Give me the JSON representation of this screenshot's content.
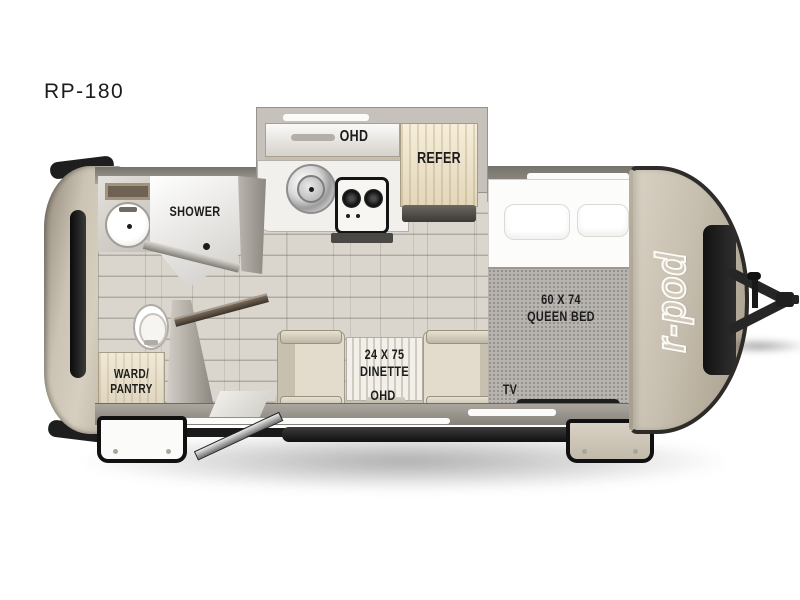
{
  "model_label": "RP-180",
  "brand_logo": "r-pod",
  "rooms": {
    "shower_label": "SHOWER",
    "kitchen_ohd_label": "OHD",
    "refer_label": "REFER",
    "queen_bed_label": "60 X 74\nQUEEN BED",
    "tv_label": "TV",
    "dinette_label": "24 X 75\nDINETTE",
    "dinette_ohd_label": "OHD",
    "ward_pantry_label": "WARD/\nPANTRY"
  },
  "colors": {
    "body_cap_beige": "#c6beae",
    "wall_gray": "#8a867f",
    "trim_black": "#1e1e1e",
    "floor_plank": "#d7d3cb",
    "cabinet_wood": "#ecdfc3",
    "label_text": "#1c1c1c"
  }
}
